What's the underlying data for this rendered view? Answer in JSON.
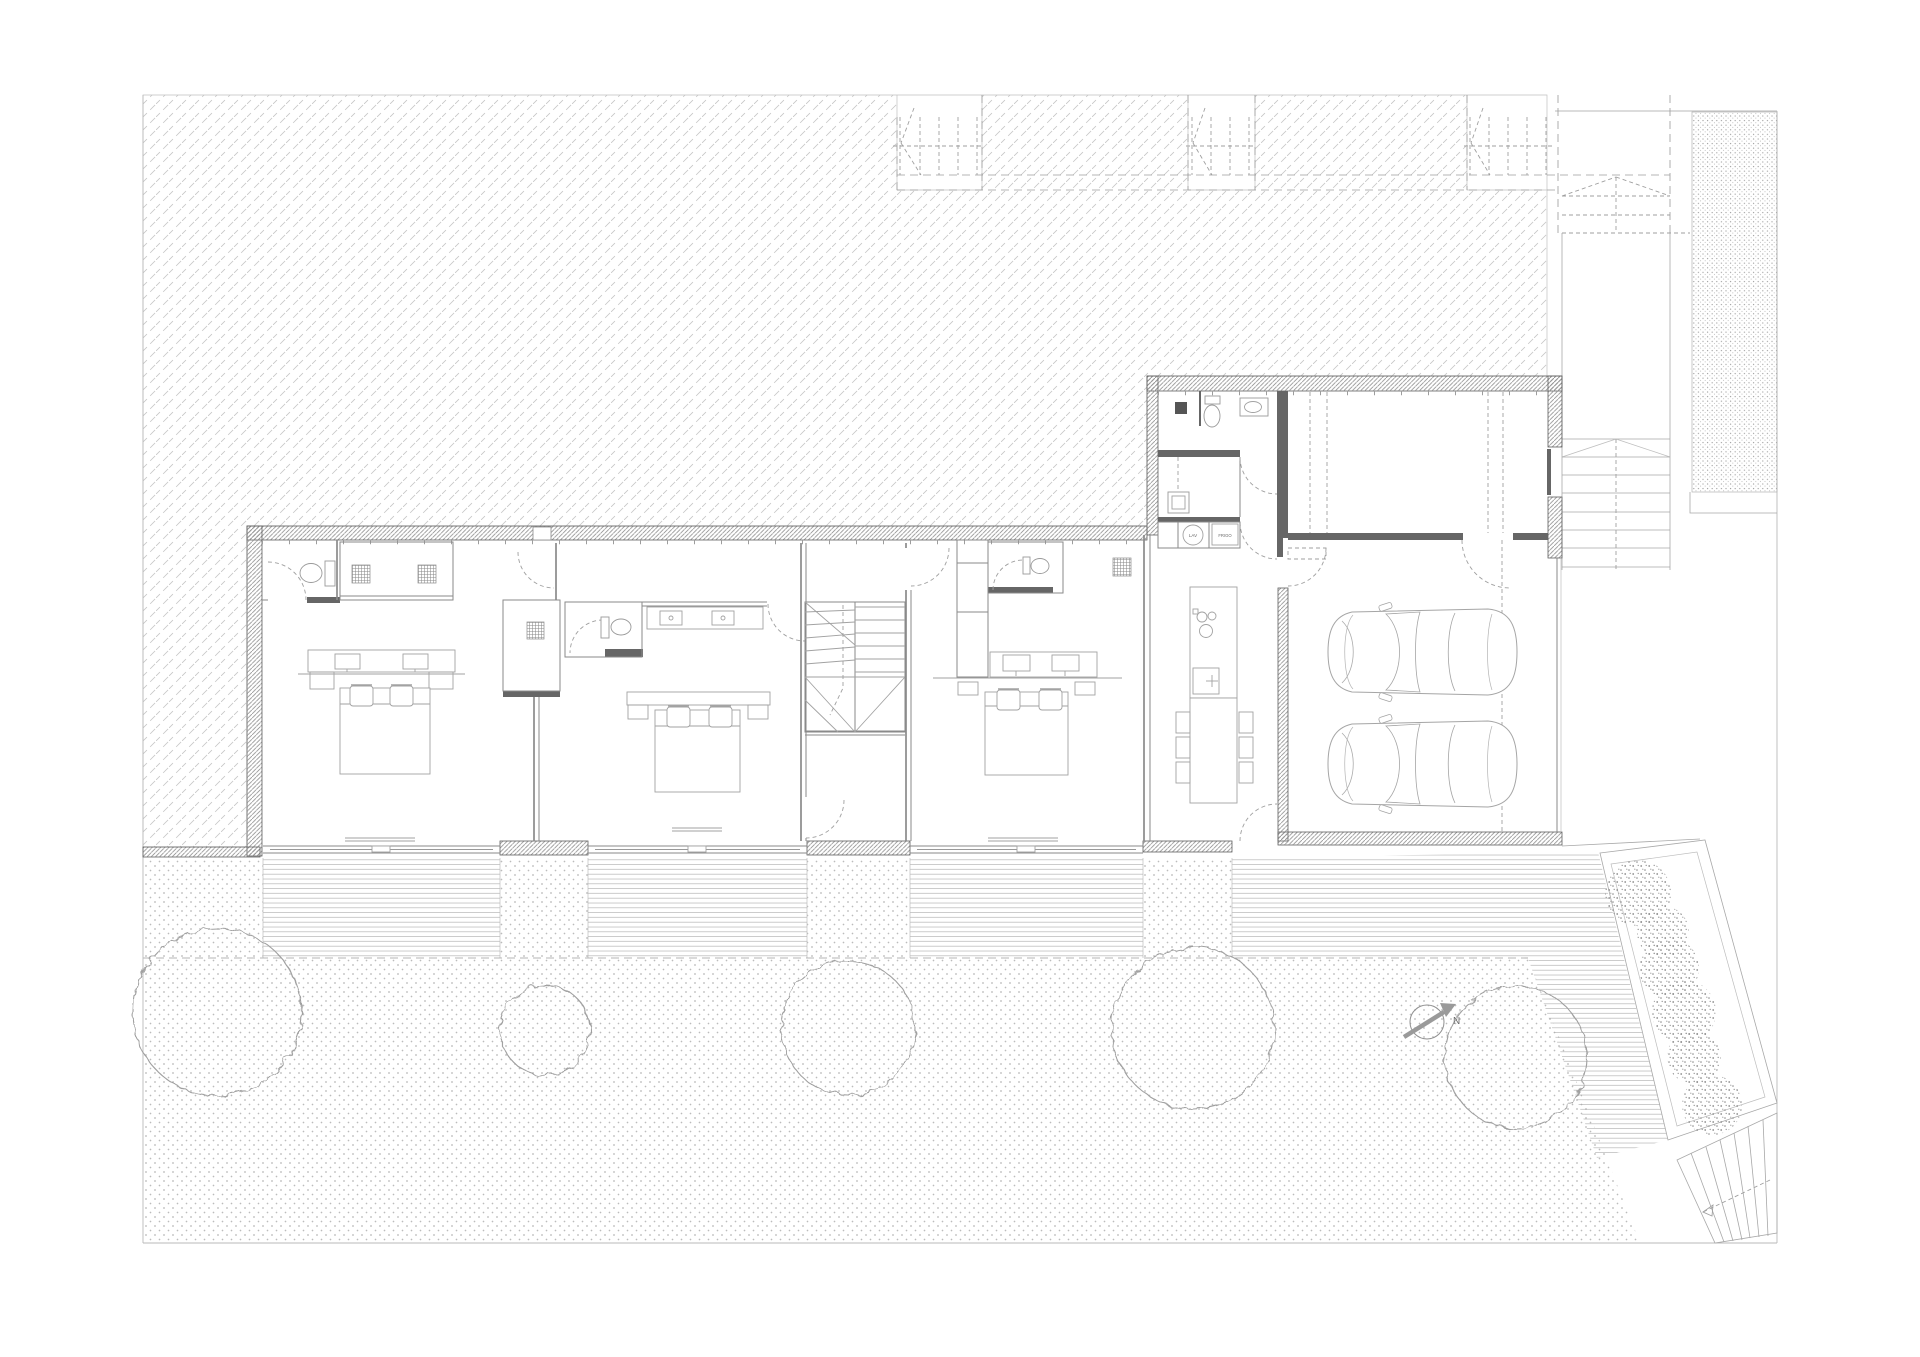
{
  "document": {
    "type": "architectural floor plan",
    "sheet": "ground floor site plan"
  },
  "labels": {
    "washer": "LAV",
    "fridge": "FRIGO",
    "north_arrow": "N"
  },
  "inventory": {
    "bedrooms": 3,
    "bathrooms": 4,
    "cars_in_carport": 2,
    "garden_trees": 5,
    "planting_clusters": 6,
    "stairs": "interior winder stair, two exterior stairs"
  },
  "colors": {
    "paper": "#ffffff",
    "site_hatch": "#c6c6c6",
    "ground_dots": "#b4b4b4",
    "stipple": "#9e9e9e",
    "deck_lines": "#a9a9a9",
    "wall_edge": "#5f5f5f",
    "partition": "#8a8a8a",
    "furniture": "#a2a2a2",
    "fixture": "#9a9a9a",
    "dashed": "#9f9f9f",
    "dark_fitting": "#666666",
    "tree_outline": "#9f9f9f",
    "text": "#6a6a6a"
  }
}
